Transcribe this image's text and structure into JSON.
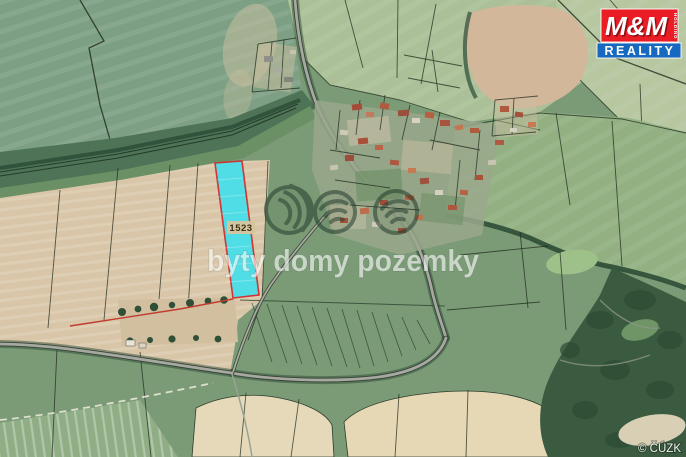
{
  "map": {
    "parcel": {
      "label": "1523",
      "fill": "#49dfe9",
      "border": "#cf2f2f",
      "label_bg": "#d7c49e"
    },
    "watermark": {
      "text": "byty domy pozemky"
    },
    "attribution": {
      "text": "© ČÚZK"
    }
  },
  "logo": {
    "mm": "M&M",
    "holding": "HOLDING",
    "reality": "REALITY",
    "red": "#ea1c25",
    "blue": "#1769c0"
  }
}
